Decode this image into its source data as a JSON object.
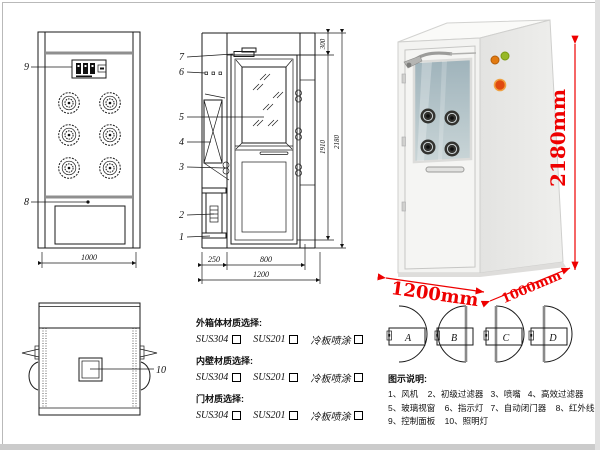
{
  "frame": {
    "bg": "#ffffff",
    "border": "#b9b9b9",
    "dimension_color": "#ee0000"
  },
  "front_view": {
    "callout_control_panel": "9",
    "callout_grille": "8",
    "dim_width": "1000"
  },
  "side_view": {
    "callouts": [
      "7",
      "6",
      "5",
      "4",
      "3",
      "2",
      "1"
    ],
    "dim_top": "300",
    "dim_door_height": "1910",
    "dim_total_height": "2180",
    "dim_bottom_left": "250",
    "dim_bottom_mid": "800",
    "dim_bottom_total": "1200"
  },
  "top_view": {
    "callout_lamp": "10"
  },
  "photo": {
    "dim_height": "2180mm",
    "dim_width": "1200mm",
    "dim_depth": "1000mm",
    "indicator_colors": {
      "orange": "#e27a10",
      "green": "#97b827",
      "button": "#e04a10"
    }
  },
  "materials": {
    "groups": [
      {
        "title": "外箱体材质选择:",
        "options": [
          "SUS304",
          "SUS201",
          "冷板喷涂"
        ]
      },
      {
        "title": "内壁材质选择:",
        "options": [
          "SUS304",
          "SUS201",
          "冷板喷涂"
        ]
      },
      {
        "title": "门材质选择:",
        "options": [
          "SUS304",
          "SUS201",
          "冷板喷涂"
        ]
      }
    ]
  },
  "door_options": {
    "labels": [
      "A",
      "B",
      "C",
      "D"
    ]
  },
  "legend": {
    "title": "图示说明:",
    "lines": [
      "1、风机    2、初级过滤器   3、喷嘴   4、高效过滤器",
      "5、玻璃视窗    6、指示灯   7、自动闭门器    8、红外线感应器",
      "9、控制面板    10、照明灯"
    ]
  }
}
